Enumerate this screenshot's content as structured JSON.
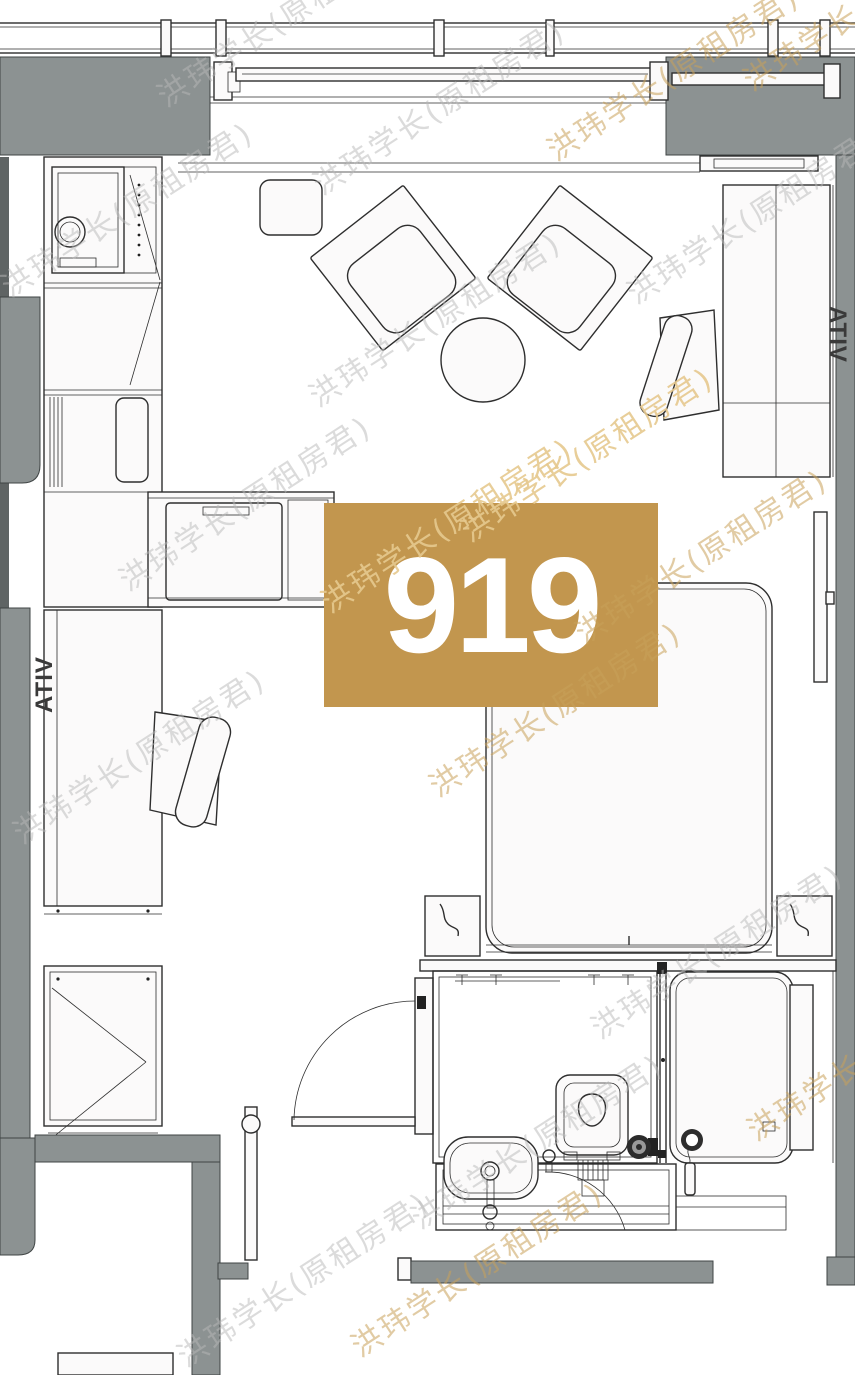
{
  "plan": {
    "unit_label": "919",
    "watermark": {
      "text": "洪玮学长(原租房君)"
    },
    "laptop_brand": "ATIV",
    "colors": {
      "accent_gold": "#c2964e",
      "wall_gray": "#8c9292",
      "wall_dark": "#5f6464",
      "line": "#2e2e2e",
      "watermark_gray": "#b9b9b9",
      "watermark_tan": "#c9a25a",
      "watermark_on_gold": "#e6c98f"
    }
  }
}
